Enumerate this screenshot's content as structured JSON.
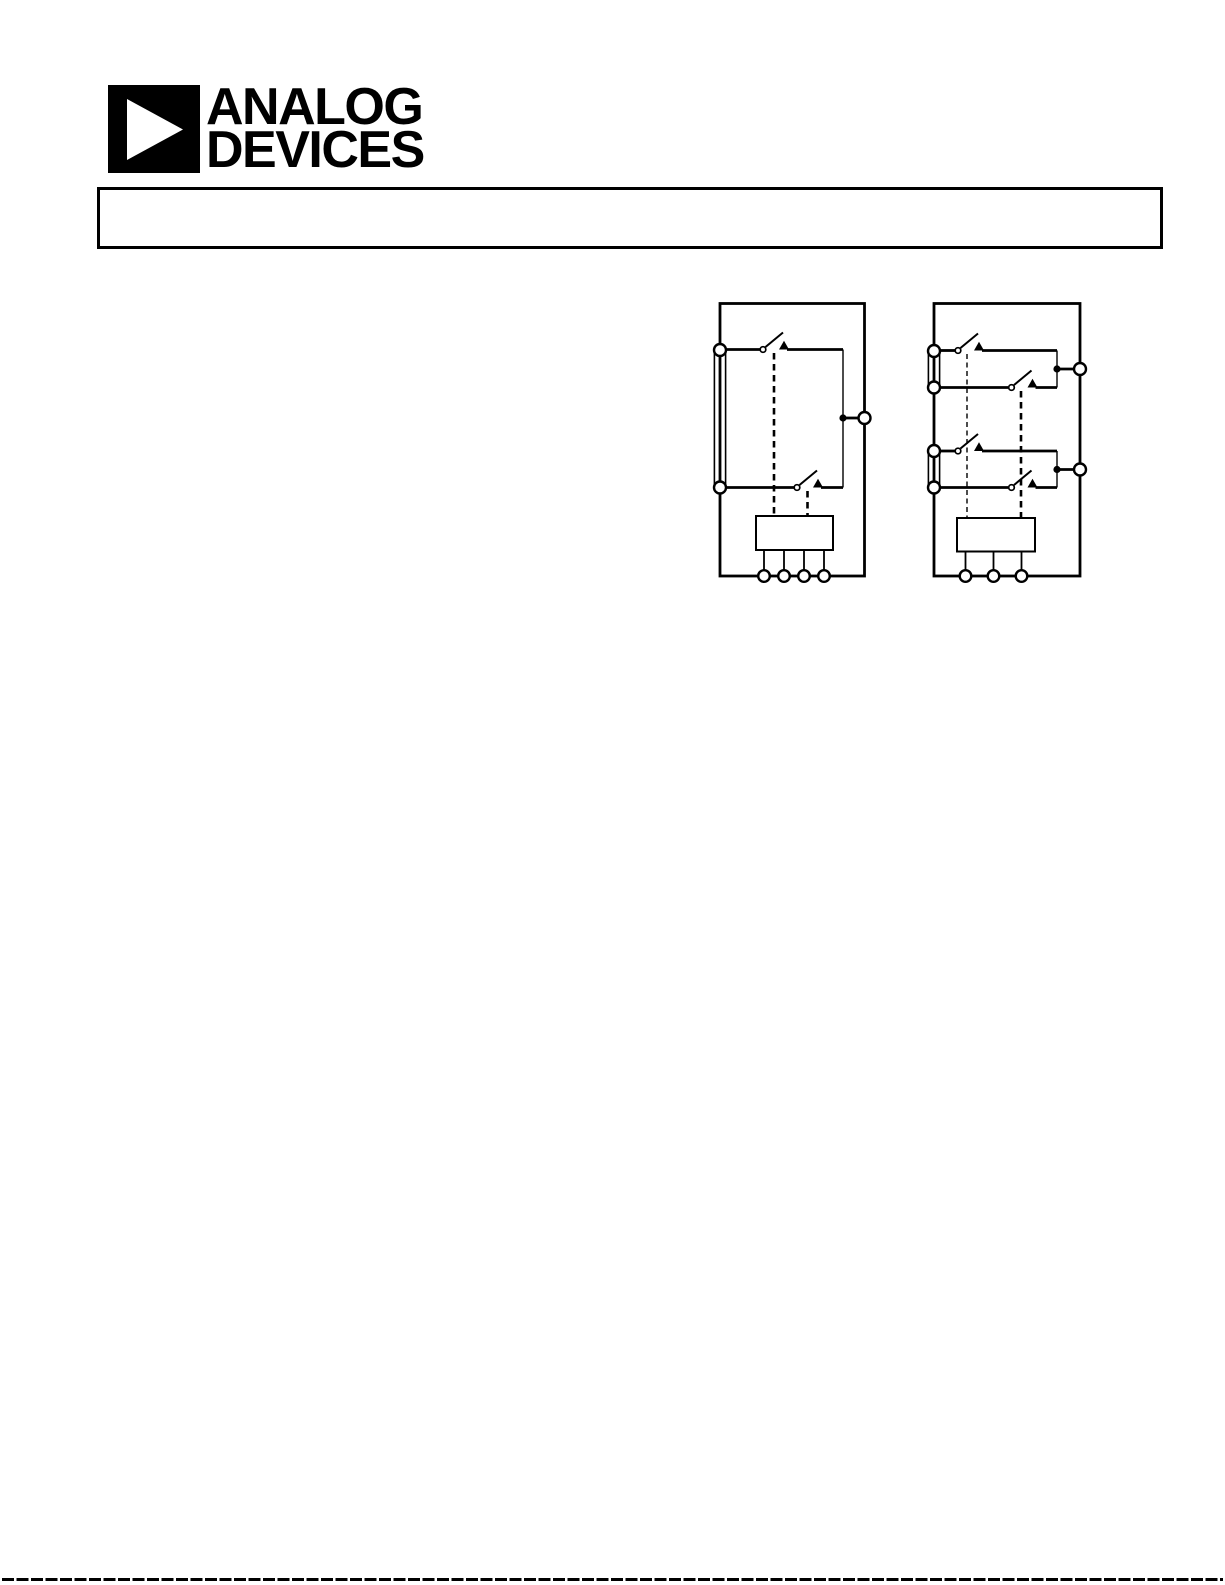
{
  "page": {
    "background": "#ffffff",
    "ink": "#000000"
  },
  "logo": {
    "line1": "ANALOG",
    "line2": "DEVICES",
    "mark_icon": "right-pointing-triangle-in-square"
  },
  "header_box": {
    "text": ""
  },
  "figures": {
    "left_diagram": {
      "type": "functional-block-diagram",
      "left_terminals": 2,
      "right_terminals": 1,
      "bottom_pins": 4,
      "switch_count": 2,
      "control_box_label": ""
    },
    "right_diagram": {
      "type": "functional-block-diagram",
      "left_terminals": 4,
      "right_terminals": 2,
      "bottom_pins": 3,
      "switch_count": 4,
      "control_box_label": ""
    }
  },
  "footer": {
    "divider_style": "dashed"
  }
}
